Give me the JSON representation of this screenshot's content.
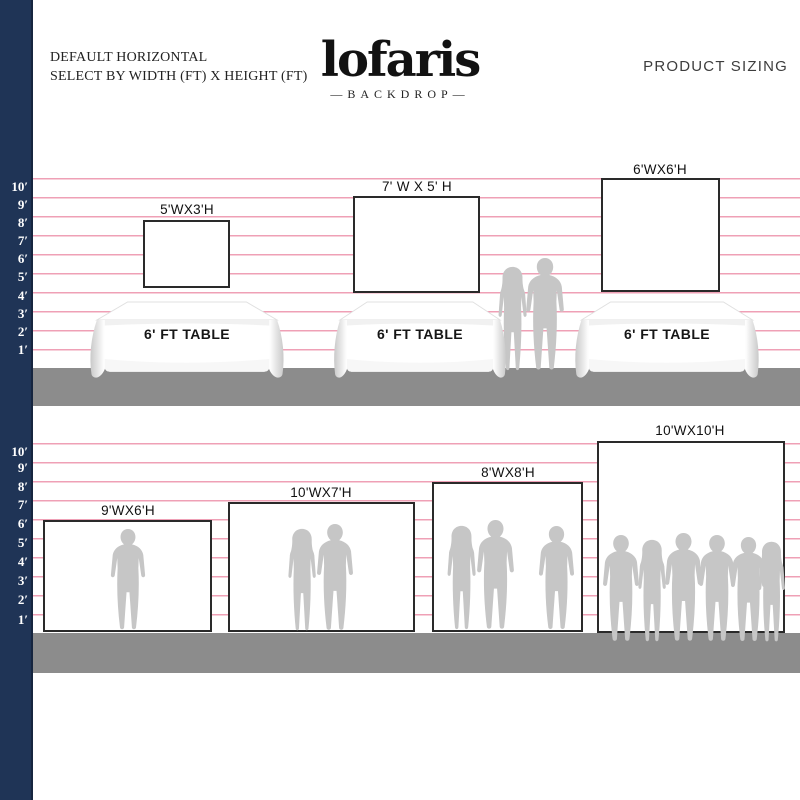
{
  "header": {
    "subtitle_line1": "DEFAULT HORIZONTAL",
    "subtitle_line2": "SELECT BY WIDTH (FT) X HEIGHT (FT)",
    "logo_text": "lofaris",
    "logo_tagline": "—BACKDROP—",
    "right_title": "PRODUCT SIZING"
  },
  "ruler": {
    "unit": "ft",
    "labels": [
      "10′",
      "9′",
      "8′",
      "7′",
      "6′",
      "5′",
      "4′",
      "3′",
      "2′",
      "1′"
    ]
  },
  "top_section": {
    "backdrops": [
      {
        "label": "5'WX3'H",
        "width_ft": 5,
        "height_ft": 3
      },
      {
        "label": "7' W X 5' H",
        "width_ft": 7,
        "height_ft": 5
      },
      {
        "label": "6'WX6'H",
        "width_ft": 6,
        "height_ft": 6
      }
    ],
    "tables": [
      {
        "label": "6' FT TABLE"
      },
      {
        "label": "6' FT TABLE"
      },
      {
        "label": "6' FT TABLE"
      }
    ]
  },
  "bottom_section": {
    "backdrops": [
      {
        "label": "9'WX6'H",
        "width_ft": 9,
        "height_ft": 6
      },
      {
        "label": "10'WX7'H",
        "width_ft": 10,
        "height_ft": 7
      },
      {
        "label": "8'WX8'H",
        "width_ft": 8,
        "height_ft": 8
      },
      {
        "label": "10'WX10'H",
        "width_ft": 10,
        "height_ft": 10
      }
    ]
  },
  "colors": {
    "navy": "#1f3456",
    "gridline": "#efa0b6",
    "floor": "#8c8c8c",
    "silhouette": "#c6c6c6"
  }
}
